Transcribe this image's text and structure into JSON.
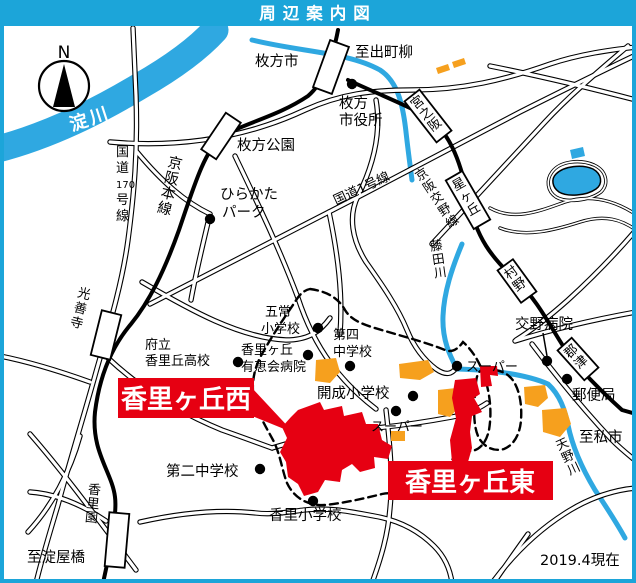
{
  "title": "周辺案内図",
  "note": "2019.4現在",
  "compass_n": "N",
  "colors": {
    "frame": "#1CA5D9",
    "water": "#2FA8E1",
    "area_red": "#E60012",
    "area_orange": "#F6A01E"
  },
  "rivers": {
    "yodo": "淀川",
    "fujita": "藤田川",
    "amano": "天野川"
  },
  "roads": {
    "route170": "国道170号線",
    "route1": "国道1号線"
  },
  "railways": {
    "main": "京阪本線",
    "katano": "京阪交野線"
  },
  "stations": {
    "miyanosaka": "宮之阪",
    "hoshigaoka": "星ヶ丘",
    "murano": "村野",
    "kozu": "郡津",
    "kozenji": "光善寺",
    "korien": "香里園"
  },
  "directions": {
    "demachiyanagi": "至出町柳",
    "yodoyabashi": "至淀屋橋",
    "kisaichi": "至私市"
  },
  "places": {
    "hirakata_city": "枚方市",
    "cityhall1": "枚方",
    "cityhall2": "市役所",
    "hirakata_koen": "枚方公園",
    "hirapark1": "ひらかた",
    "hirapark2": "パーク",
    "gojo1": "五常",
    "gojo2": "小学校",
    "daishi1": "第四",
    "daishi2": "中学校",
    "yukei1": "香里ヶ丘",
    "yukei2": "有恵会病院",
    "koko1": "府立",
    "koko2": "香里丘高校",
    "kaisei": "開成小学校",
    "super_west": "スーパー",
    "super_east": "スーパー",
    "katano_hospital": "交野病院",
    "post_office": "郵便局",
    "daini": "第二中学校",
    "kori_elementary": "香里小学校"
  },
  "banners": {
    "west": "香里ヶ丘西",
    "east": "香里ヶ丘東"
  }
}
